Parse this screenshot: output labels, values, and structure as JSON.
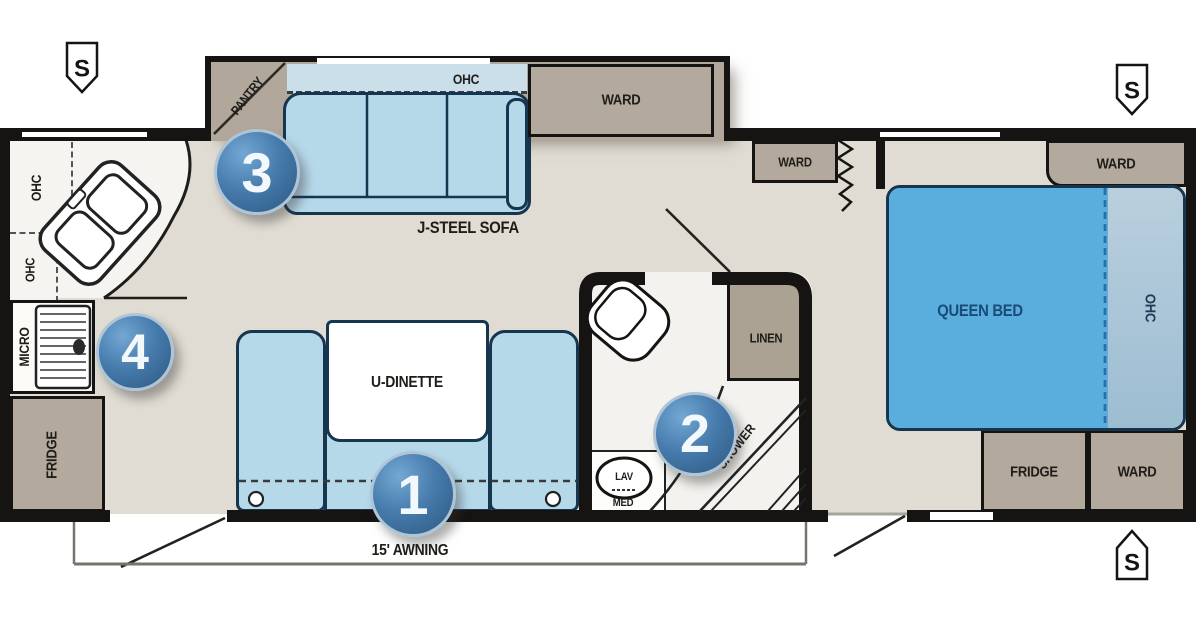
{
  "floorplan": {
    "title": "Travel trailer floor plan",
    "labels": {
      "pantry": "PANTRY",
      "ohc": "OHC",
      "ward": "WARD",
      "sofa": "J-STEEL SOFA",
      "dinette": "U-DINETTE",
      "queen_bed": "QUEEN BED",
      "fridge": "FRIDGE",
      "micro": "MICRO",
      "linen": "LINEN",
      "shower": "SHOWER",
      "lav": "LAV",
      "med": "MED",
      "awning": "15' AWNING",
      "speaker": "S"
    },
    "callouts": {
      "c1": "1",
      "c2": "2",
      "c3": "3",
      "c4": "4"
    },
    "colors": {
      "wall": "#161412",
      "floor": "#e0dcd3",
      "cabinet_tan": "#b3a99c",
      "furniture_blue": "#b6d9ea",
      "bed_blue": "#5aaede",
      "callout_blue": "#3a74a6"
    }
  }
}
